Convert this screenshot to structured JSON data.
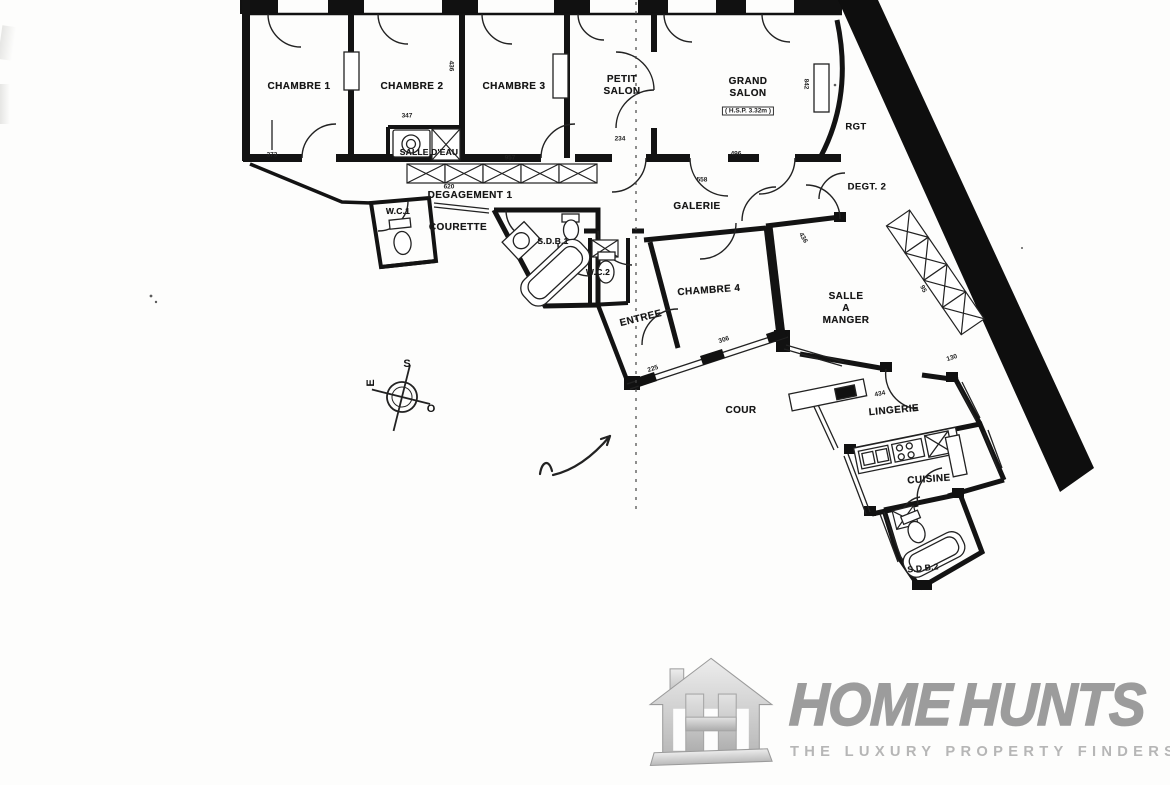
{
  "plan": {
    "rooms": [
      {
        "label": "CHAMBRE 1"
      },
      {
        "label": "CHAMBRE 2"
      },
      {
        "label": "CHAMBRE 3"
      },
      {
        "label": "PETIT\nSALON"
      },
      {
        "label": "GRAND\nSALON"
      },
      {
        "label": "SALLE D'EAU"
      },
      {
        "label": "DEGAGEMENT 1"
      },
      {
        "label": "GALERIE"
      },
      {
        "label": "RGT"
      },
      {
        "label": "DEGT. 2"
      },
      {
        "label": "W.C.1"
      },
      {
        "label": "COURETTE"
      },
      {
        "label": "S.D.B.1"
      },
      {
        "label": "W.C.2"
      },
      {
        "label": "ENTREE"
      },
      {
        "label": "CHAMBRE 4"
      },
      {
        "label": "SALLE\nA\nMANGER"
      },
      {
        "label": "COUR"
      },
      {
        "label": "LINGERIE"
      },
      {
        "label": "CUISINE"
      },
      {
        "label": "S.D.B.2"
      }
    ],
    "ceiling_note": "( H.S.P. 3.32m )",
    "dims": [
      {
        "v": "373"
      },
      {
        "v": "347"
      },
      {
        "v": "436"
      },
      {
        "v": "957"
      },
      {
        "v": "620"
      },
      {
        "v": "234"
      },
      {
        "v": "496"
      },
      {
        "v": "558"
      },
      {
        "v": "842"
      },
      {
        "v": "436"
      },
      {
        "v": "306"
      },
      {
        "v": "225"
      },
      {
        "v": "130"
      },
      {
        "v": "434"
      },
      {
        "v": "95"
      }
    ],
    "compass": {
      "south": "S",
      "east": "E",
      "west": "O"
    }
  },
  "logo": {
    "brand_part1": "HOME",
    "brand_part2": "HUNTS",
    "tagline": "THE LUXURY PROPERTY FINDERS",
    "brand_color": "#9c9c9c",
    "tagline_color": "#b6b6b6"
  }
}
